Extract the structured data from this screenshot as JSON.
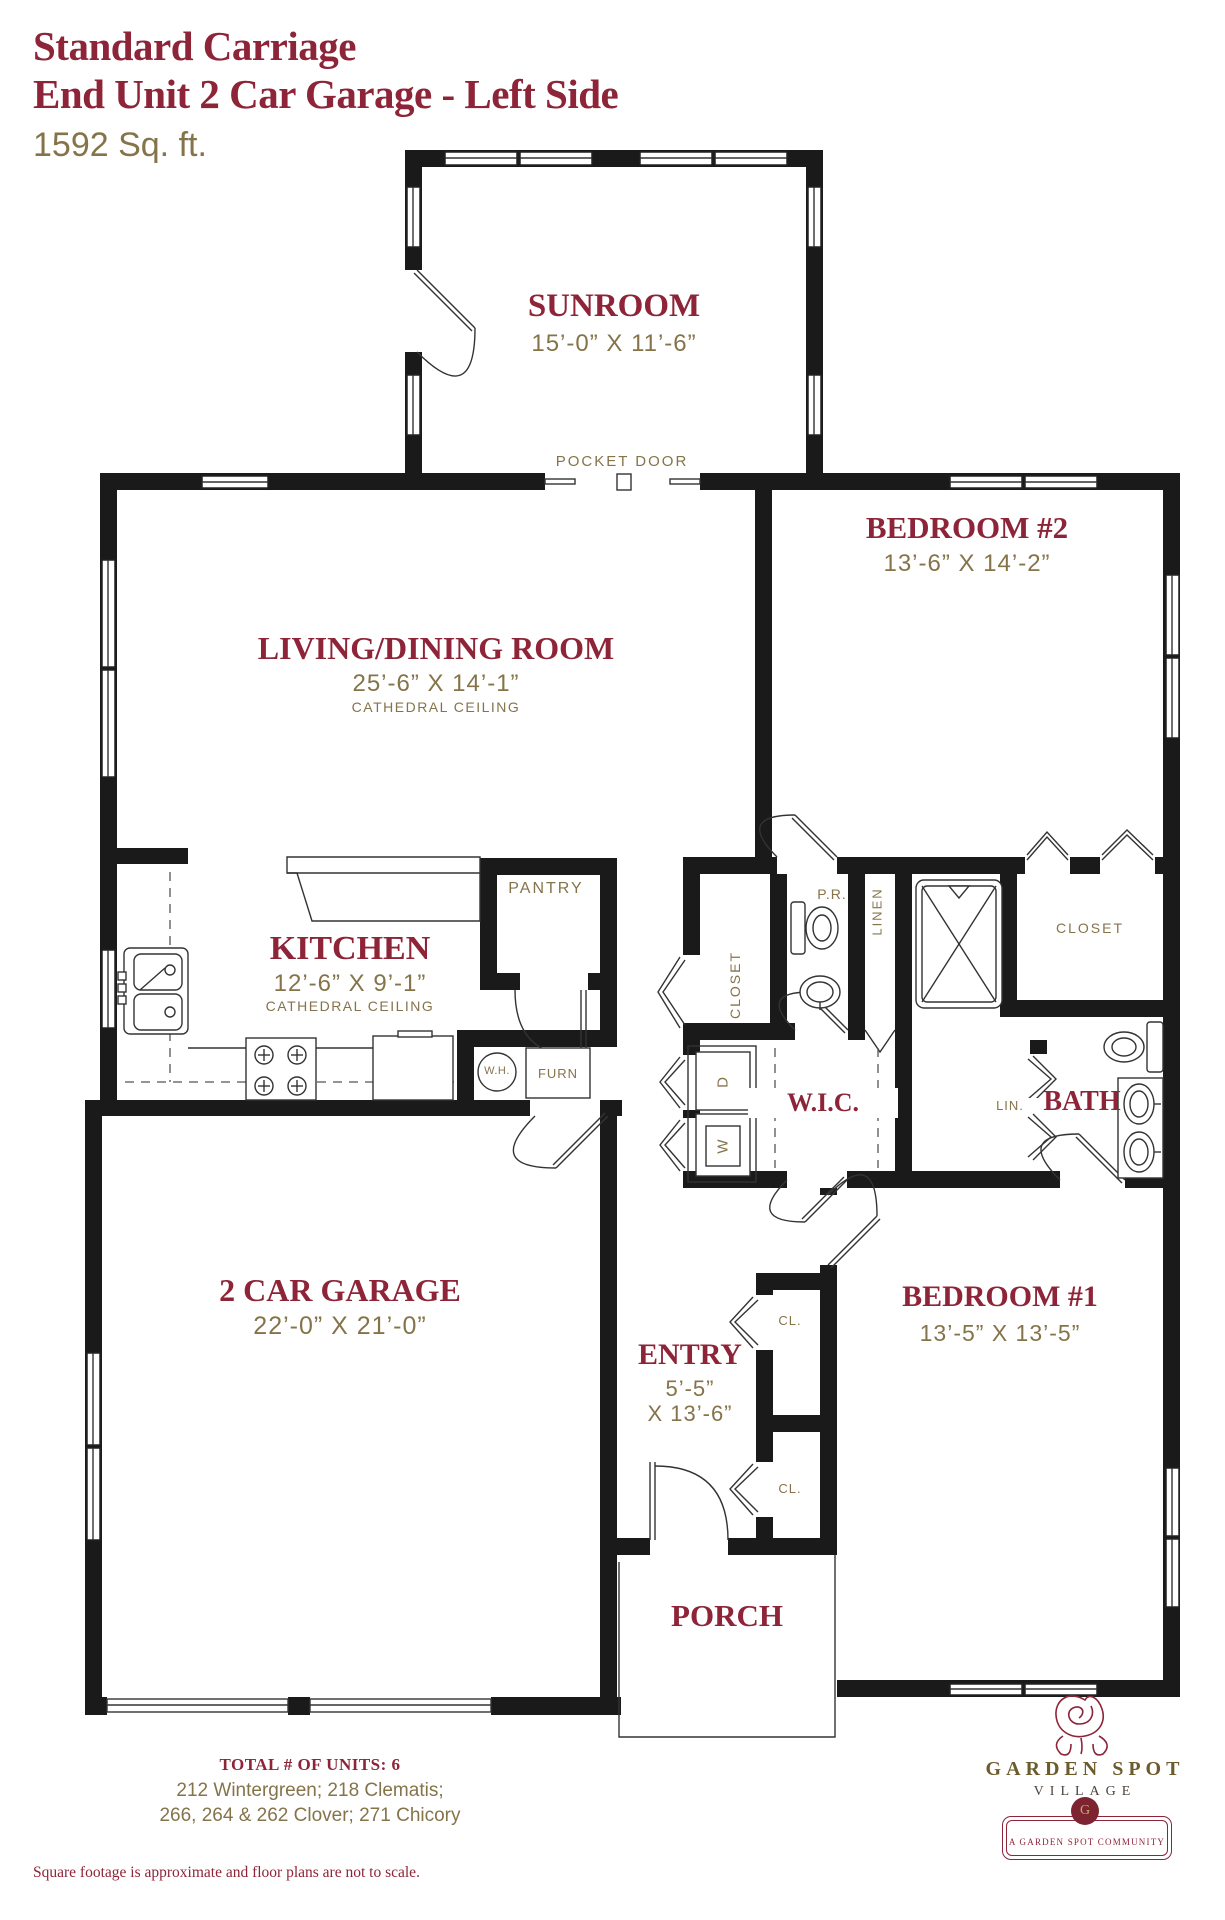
{
  "colors": {
    "maroon": "#8d2438",
    "olive": "#85744a",
    "wall": "#1a1a1a"
  },
  "title": {
    "line1": "Standard Carriage",
    "line2": "End Unit 2 Car Garage - Left Side",
    "area": "1592 Sq. ft."
  },
  "rooms": {
    "sunroom": {
      "name": "SUNROOM",
      "dims": "15’-0” X 11’-6”"
    },
    "living": {
      "name": "LIVING/DINING ROOM",
      "dims": "25’-6” X 14’-1”",
      "note": "CATHEDRAL CEILING"
    },
    "bedroom2": {
      "name": "BEDROOM #2",
      "dims": "13’-6” X 14’-2”"
    },
    "kitchen": {
      "name": "KITCHEN",
      "dims": "12’-6” X 9’-1”",
      "note": "CATHEDRAL CEILING"
    },
    "garage": {
      "name": "2 CAR GARAGE",
      "dims": "22’-0” X 21’-0”"
    },
    "entry": {
      "name": "ENTRY",
      "dims1": "5’-5”",
      "dims2": "X 13’-6”"
    },
    "bedroom1": {
      "name": "BEDROOM #1",
      "dims": "13’-5” X 13’-5”"
    },
    "wic": {
      "name": "W.I.C."
    },
    "bath": {
      "name": "BATH"
    },
    "porch": {
      "name": "PORCH"
    }
  },
  "labels": {
    "pocket_door": "POCKET DOOR",
    "pantry": "PANTRY",
    "hall_closet": "CLOSET",
    "bedroom2_closet": "CLOSET",
    "linen": "LINEN",
    "lin": "LIN.",
    "powder_room": "P.R.",
    "water_heater": "W.H.",
    "furnace": "FURN",
    "dryer": "D",
    "washer": "W",
    "closet1": "CL.",
    "closet2": "CL."
  },
  "footer": {
    "total_units": "TOTAL # OF UNITS: 6",
    "addresses1": "212 Wintergreen; 218 Clematis;",
    "addresses2": "266, 264 & 262 Clover; 271 Chicory",
    "disclaimer": "Square footage is approximate and floor plans are not to scale."
  },
  "logo": {
    "brand": "GARDEN SPOT",
    "brand_sub": "VILLAGE",
    "badge": "G",
    "tagline": "A GARDEN SPOT COMMUNITY"
  }
}
